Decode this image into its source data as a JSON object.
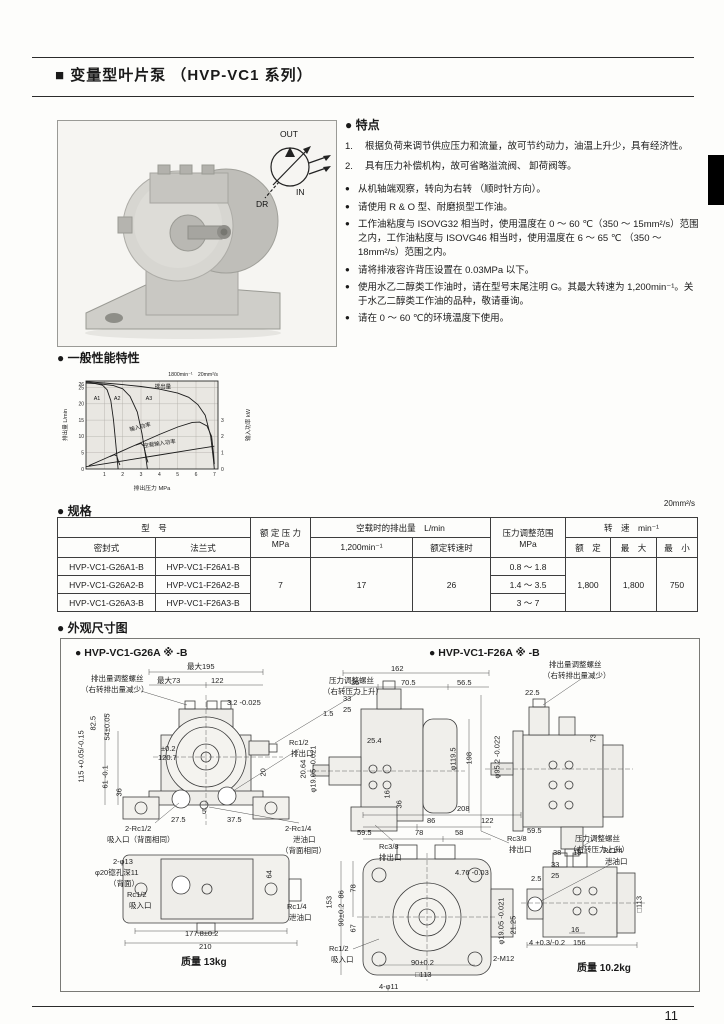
{
  "page": {
    "number": "11"
  },
  "header": {
    "title": "■ 变量型叶片泵 （HVP-VC1 系列）"
  },
  "photo": {
    "symbol": {
      "out": "OUT",
      "in": "IN",
      "dr": "DR"
    }
  },
  "features": {
    "heading": "● 特点",
    "numbered": [
      {
        "no": "1.",
        "text": "根据负荷来调节供应压力和流量，故可节约动力，油温上升少，具有经济性。"
      },
      {
        "no": "2.",
        "text": "具有压力补偿机构，故可省略溢流阀、 卸荷阀等。"
      }
    ],
    "bullet_mark": "●",
    "bullets": [
      "从机轴端观察，转向为右转 （顺时针方向）。",
      "请使用 R & O 型、耐磨损型工作油。",
      "工作油粘度与 ISOVG32 相当时，使用温度在 0 ～ 60 ℃（350 ～ 15mm²/s）范围之内，工作油粘度与 ISOVG46 相当时，使用温度在 6 ～ 65 ℃ （350 ～ 18mm²/s）范围之内。",
      "请将排液容许背压设置在 0.03MPa 以下。",
      "使用水乙二醇类工作油时，请在型号末尾注明 G。其最大转速为 1,200min⁻¹。关于水乙二醇类工作油的品种，敬请垂询。",
      "请在 0 ～ 60 ℃的环境温度下使用。"
    ]
  },
  "performance": {
    "heading": "● 一般性能特性"
  },
  "chart_data": {
    "type": "line",
    "title": "一般性能特性",
    "condition": "1800min⁻¹　20mm²/s",
    "xlabel": "排出压力  MPa",
    "ylabel_left": "排出量  L/min",
    "ylabel_right": "输入功率  kW",
    "xlim": [
      0,
      7.2
    ],
    "ylim_left": [
      0,
      27
    ],
    "xticks": [
      1,
      2,
      3,
      4,
      5,
      6,
      7
    ],
    "yticks_left": [
      0,
      5,
      10,
      15,
      20,
      25,
      26
    ],
    "ylim_right_ticks": [
      0,
      1,
      2,
      3
    ],
    "right_axis_scale": 5,
    "grid": true,
    "series": [
      {
        "name": "排出量 A1",
        "points": [
          [
            0,
            26.4
          ],
          [
            0.5,
            26.2
          ],
          [
            0.9,
            25.7
          ],
          [
            1.15,
            24.3
          ],
          [
            1.35,
            21.0
          ],
          [
            1.5,
            15.0
          ],
          [
            1.62,
            8.0
          ],
          [
            1.72,
            2.0
          ],
          [
            1.75,
            0
          ]
        ]
      },
      {
        "name": "排出量 A2",
        "points": [
          [
            0,
            26.5
          ],
          [
            0.8,
            26.1
          ],
          [
            1.5,
            25.6
          ],
          [
            2.0,
            24.6
          ],
          [
            2.4,
            22.3
          ],
          [
            2.8,
            17.5
          ],
          [
            3.05,
            11.0
          ],
          [
            3.25,
            4.0
          ],
          [
            3.35,
            0
          ]
        ]
      },
      {
        "name": "排出量 A3",
        "points": [
          [
            0,
            26.8
          ],
          [
            1,
            26.4
          ],
          [
            2,
            25.9
          ],
          [
            3,
            25.3
          ],
          [
            4,
            24.5
          ],
          [
            5,
            23.3
          ],
          [
            5.6,
            22.0
          ],
          [
            6.1,
            19.8
          ],
          [
            6.5,
            16.5
          ],
          [
            6.8,
            10.0
          ],
          [
            6.95,
            3.0
          ],
          [
            7.0,
            0
          ]
        ]
      },
      {
        "name": "输入功率",
        "points": [
          [
            0.15,
            1.0
          ],
          [
            1,
            3.1
          ],
          [
            2,
            5.6
          ],
          [
            3,
            8.1
          ],
          [
            4,
            10.6
          ],
          [
            5,
            12.9
          ],
          [
            5.8,
            14.3
          ],
          [
            6.2,
            14.4
          ],
          [
            6.6,
            13.2
          ],
          [
            6.85,
            10.0
          ],
          [
            6.95,
            5.0
          ],
          [
            7.0,
            1.5
          ]
        ]
      },
      {
        "name": "输入功率 A1分支",
        "points": [
          [
            1.3,
            3.8
          ],
          [
            1.55,
            4.4
          ],
          [
            1.68,
            4.0
          ],
          [
            1.78,
            2.2
          ],
          [
            1.85,
            1.2
          ]
        ]
      },
      {
        "name": "输入功率 A2分支",
        "points": [
          [
            2.7,
            7.3
          ],
          [
            3.0,
            7.9
          ],
          [
            3.15,
            7.0
          ],
          [
            3.3,
            3.5
          ],
          [
            3.38,
            2.0
          ]
        ]
      },
      {
        "name": "空载输入功率",
        "points": [
          [
            0,
            0.7
          ],
          [
            2,
            2.5
          ],
          [
            4,
            4.3
          ],
          [
            6,
            6.1
          ],
          [
            7,
            7.0
          ]
        ]
      }
    ],
    "labels_on_plot": [
      {
        "text": "排出量",
        "x": 3.75,
        "y": 24.7
      },
      {
        "text": "A1",
        "x": 0.42,
        "y": 21.2
      },
      {
        "text": "A2",
        "x": 1.52,
        "y": 21.2
      },
      {
        "text": "A3",
        "x": 3.25,
        "y": 21.2
      },
      {
        "text": "输入功率",
        "x": 2.4,
        "y": 11.6,
        "rot": -14
      },
      {
        "text": "空载输入功率",
        "x": 3.15,
        "y": 6.6,
        "rot": -8
      }
    ]
  },
  "specs": {
    "heading": "● 规格",
    "note": "20mm²/s",
    "head": {
      "model": "型　号",
      "seal": "密封式",
      "flange": "法兰式",
      "pressure": "额 定 压 力",
      "pressure_unit": "MPa",
      "flow": "空载时的排出量　L/min",
      "flow1": "1,200min⁻¹",
      "flow2": "额定转速时",
      "range": "压力调整范围",
      "range_unit": "MPa",
      "speed": "转　速　min⁻¹",
      "rated": "额　定",
      "max": "最　大",
      "min": "最　小"
    },
    "rows": [
      {
        "seal": "HVP-VC1-G26A1-B",
        "flange": "HVP-VC1-F26A1-B",
        "range": "0.8 ～ 1.8"
      },
      {
        "seal": "HVP-VC1-G26A2-B",
        "flange": "HVP-VC1-F26A2-B",
        "range": "1.4 ～ 3.5"
      },
      {
        "seal": "HVP-VC1-G26A3-B",
        "flange": "HVP-VC1-F26A3-B",
        "range": "3 ～ 7"
      }
    ],
    "merged": {
      "pressure": "7",
      "flow1": "17",
      "flow2": "26",
      "rated": "1,800",
      "max": "1,800",
      "min": "750"
    }
  },
  "dimensions": {
    "heading": "● 外观尺寸图",
    "g26a_title": "● HVP-VC1-G26A ※ -B",
    "f26a_title": "● HVP-VC1-F26A ※ -B",
    "g26a_mass": "质量  13kg",
    "f26a_mass": "质量  10.2kg",
    "g26a_labels": [
      "排出量调整螺丝",
      "（右转排出量减少）",
      "最大195",
      "最大73",
      "122",
      "压力调整螺丝",
      "（右转压力上升）",
      "82.5",
      "54±0.05",
      "115 +0.05/-0.15",
      "61 -0.1",
      "36",
      "3.2 -0.025",
      "±0.2",
      "120.7",
      "Rc1/2",
      "排出口",
      "20",
      "2-Rc1/2",
      "吸入口（背面相同）",
      "27.5",
      "5",
      "37.5",
      "2-Rc1/4",
      "泄油口",
      "（背面相同）",
      "2-φ13",
      "φ20锪孔深11",
      "（背面）",
      "Rc1/2",
      "吸入口",
      "Rc1/4",
      "泄油口",
      "64",
      "177.8±0.2",
      "210",
      "162",
      "35",
      "70.5",
      "56.5",
      "33",
      "25",
      "1.5",
      "25.4",
      "20.64",
      "φ19.05 -0.021",
      "φ119.5",
      "198",
      "16",
      "36",
      "59.5",
      "Rc3/8",
      "排出口"
    ],
    "f26a_labels": [
      "排出量调整螺丝",
      "（右转排出量减少）",
      "22.5",
      "73",
      "φ95.2 -0.022",
      "59.5",
      "压力调整螺丝",
      "（右转压力上升）",
      "208",
      "86",
      "122",
      "78",
      "58",
      "Rc3/8",
      "排出口",
      "153",
      "86",
      "78",
      "90±0.2",
      "67",
      "4.76 -0.03",
      "Rc1/2",
      "吸入口",
      "90±0.2",
      "□113",
      "4-φ11",
      "2-M12",
      "38",
      "18",
      "33",
      "25",
      "2.5",
      "Rc1/4",
      "泄油口",
      "21.25",
      "φ19.05 -0.021",
      "□113",
      "4 +0.3/-0.2",
      "16",
      "156"
    ]
  }
}
